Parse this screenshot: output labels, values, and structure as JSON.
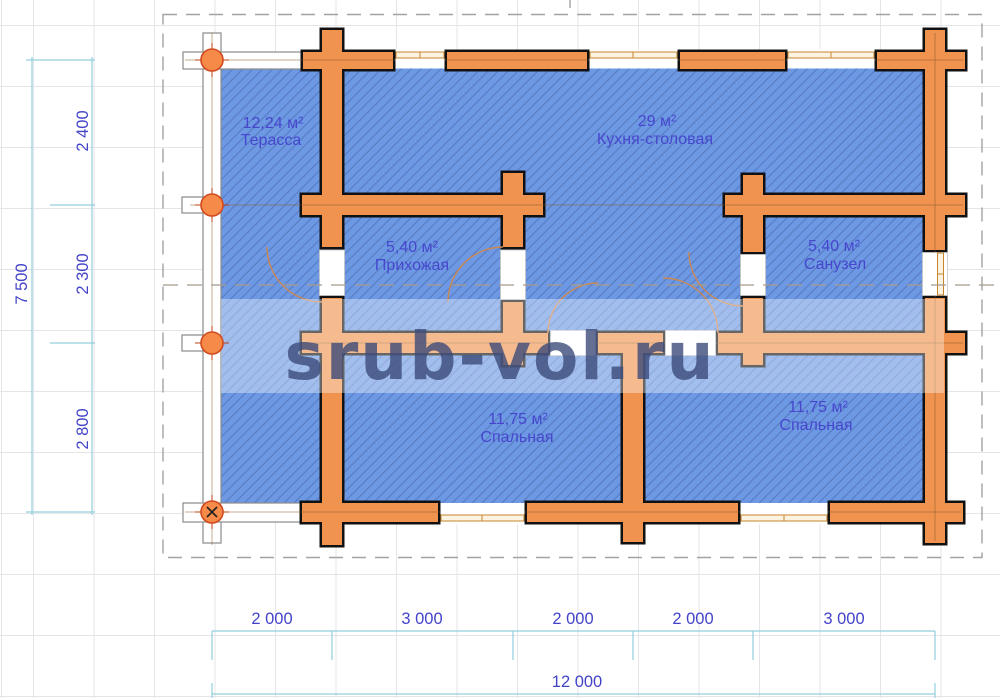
{
  "title": "House floor plan",
  "watermark": {
    "text": "srub-vol.ru"
  },
  "rooms": [
    {
      "id": "terrace",
      "area": "12,24 м²",
      "name": "Терасса"
    },
    {
      "id": "kitchen-dining",
      "area": "29 м²",
      "name": "Кухня-столовая"
    },
    {
      "id": "hallway",
      "area": "5,40 м²",
      "name": "Прихожая"
    },
    {
      "id": "bathroom",
      "area": "5,40 м²",
      "name": "Санузел"
    },
    {
      "id": "bedroom-left",
      "area": "11,75 м²",
      "name": "Спальная"
    },
    {
      "id": "bedroom-right",
      "area": "11,75 м²",
      "name": "Спальная"
    }
  ],
  "dimensions": {
    "left": {
      "total": "7 500",
      "segments": [
        "2 400",
        "2 300",
        "2 800"
      ]
    },
    "bottom": {
      "total": "12 000",
      "segments": [
        "2 000",
        "3 000",
        "2 000",
        "2 000",
        "3 000"
      ]
    }
  },
  "colors": {
    "wall_fill": "#f0934e",
    "wall_outline": "#111111",
    "floor_blue": "#6d99e4",
    "hatch": "#4c6cb4",
    "dimension_line": "#92cfdd",
    "label_text": "#4747cd",
    "watermark_text": "#3c4b79",
    "log_end": "#f58a49",
    "border_dash": "#a2a2a2"
  }
}
